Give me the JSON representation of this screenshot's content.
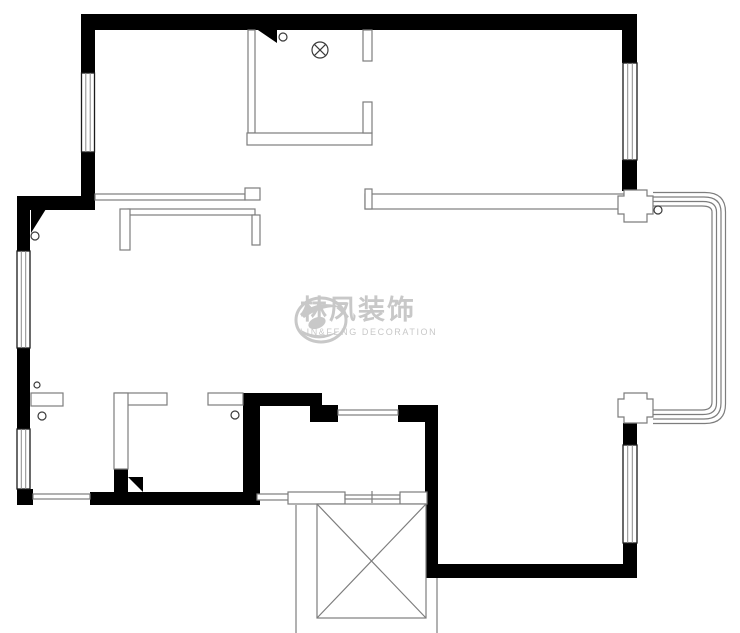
{
  "watermark": {
    "brand_cn": "林凤装饰",
    "brand_en": "LIN&FENG DECORATION"
  },
  "colors": {
    "wall": "#000000",
    "partition_line": "#7d7d7d",
    "watermark": "#c8c8c8",
    "background": "#ffffff"
  }
}
